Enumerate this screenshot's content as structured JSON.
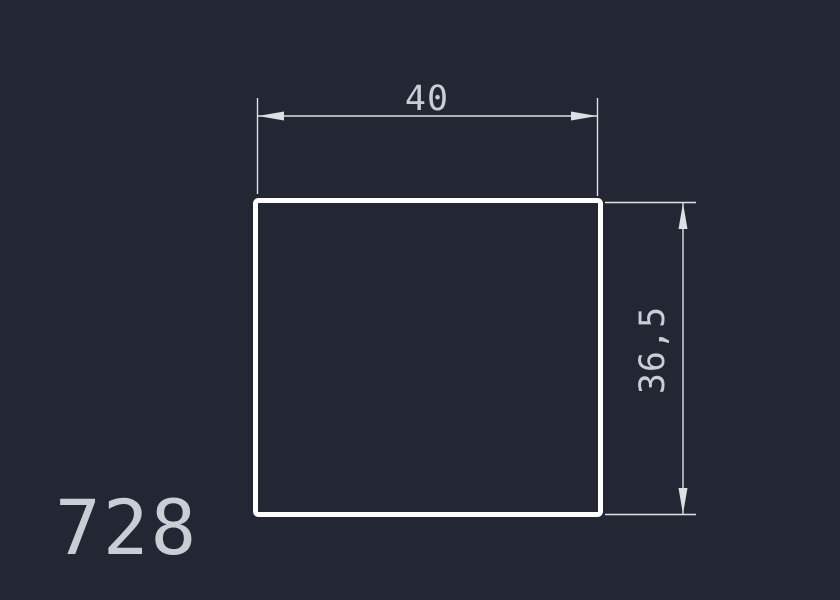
{
  "colors": {
    "background": "#222733",
    "outline": "#ffffff",
    "dimension": "#dde1e6",
    "text": "#c9ced5"
  },
  "drawing": {
    "number": "728",
    "width_dimension": {
      "value": "40"
    },
    "height_dimension": {
      "value": "36,5"
    }
  }
}
